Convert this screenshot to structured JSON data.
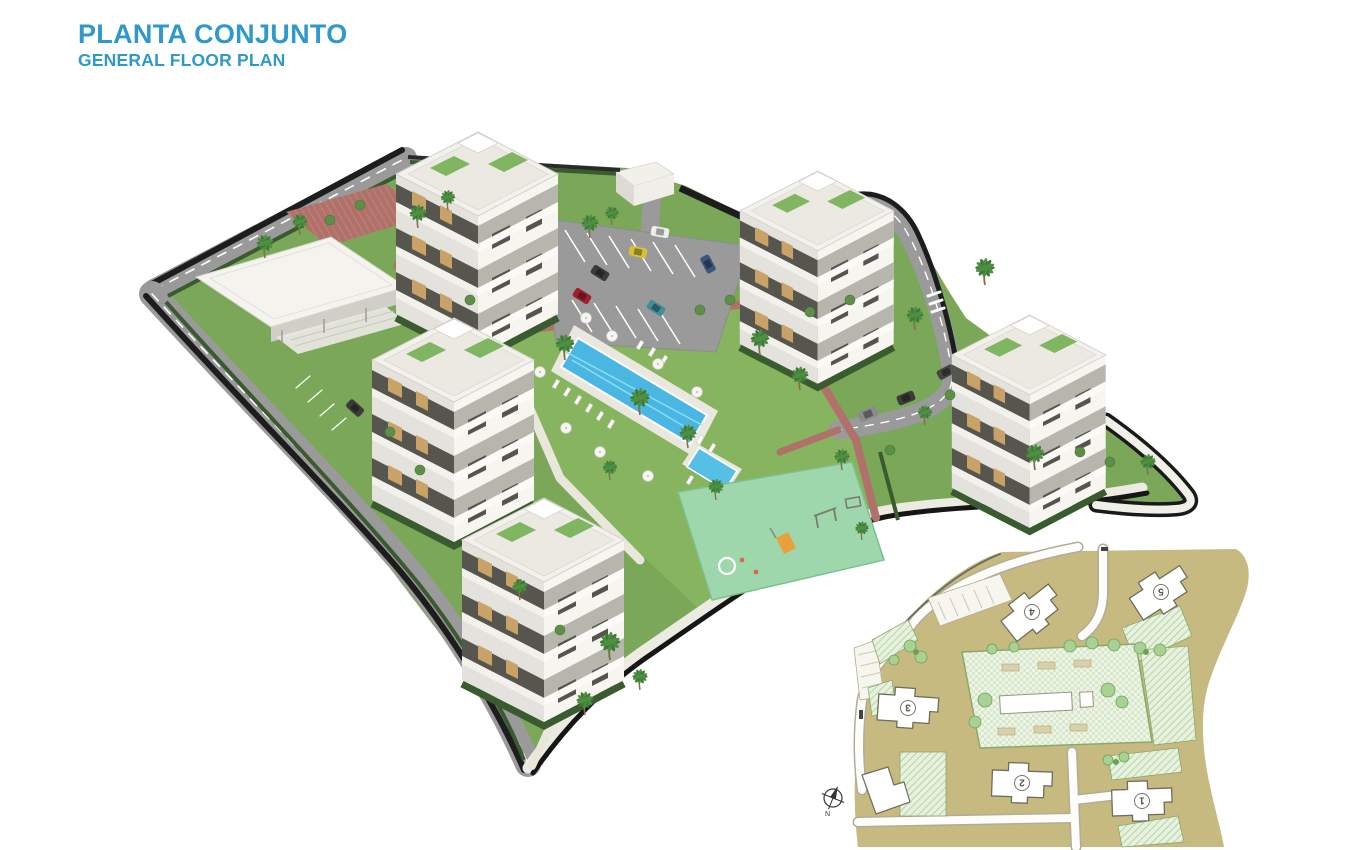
{
  "header": {
    "title": "PLANTA CONJUNTO",
    "subtitle": "GENERAL FLOOR PLAN"
  },
  "colors": {
    "accent_blue": "#2f99cc",
    "pool_blue": "#4ab6e2",
    "grass_green": "#7aa758",
    "lawn_green": "#87b45e",
    "road_gray": "#9a9a9a",
    "boundary_dark": "#1d1d1d",
    "paving_red": "#b0716a",
    "playground_green": "#9fd7ad",
    "building_white": "#f2f1ec",
    "inset_tan": "#c6ba80"
  },
  "inset": {
    "buildings": [
      {
        "label": "1"
      },
      {
        "label": "2"
      },
      {
        "label": "3"
      },
      {
        "label": "4"
      },
      {
        "label": "5"
      }
    ],
    "compass_label": "N"
  }
}
